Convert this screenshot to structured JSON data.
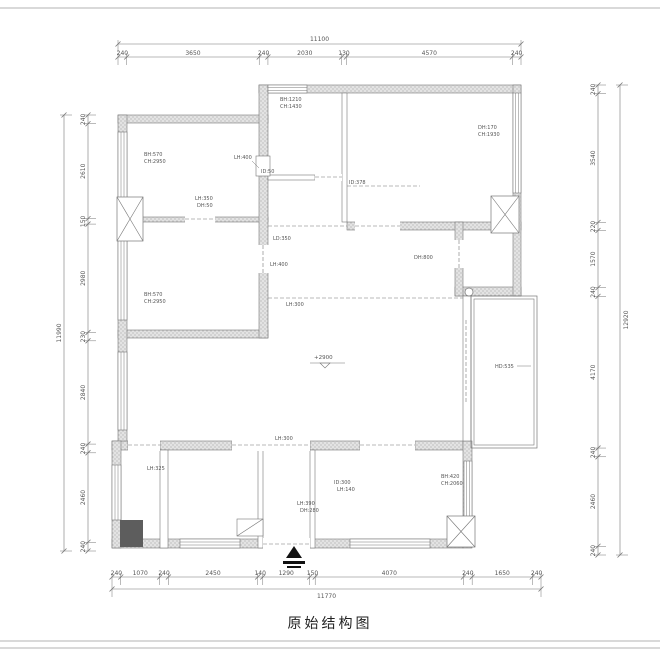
{
  "sheet": {
    "title": "原始结构图"
  },
  "dimensions": {
    "top": {
      "total": "11100",
      "segments": [
        "240",
        "3650",
        "240",
        "2030",
        "130",
        "4570",
        "240"
      ]
    },
    "bottom": {
      "total": "11770",
      "segments": [
        "240",
        "1070",
        "240",
        "2450",
        "140",
        "1290",
        "150",
        "4070",
        "240",
        "1650",
        "240"
      ]
    },
    "left": {
      "total": "11990",
      "segments": [
        "240",
        "2610",
        "150",
        "2980",
        "230",
        "2840",
        "240",
        "2460",
        "240"
      ]
    },
    "right": {
      "total": "12920",
      "segments": [
        "240",
        "3540",
        "220",
        "1570",
        "240",
        "4170",
        "240",
        "2460",
        "240"
      ]
    }
  },
  "level_mark": {
    "text": "+2900",
    "x": 314,
    "y": 359
  },
  "annotations": [
    {
      "text": "BH:570",
      "x": 144,
      "y": 156
    },
    {
      "text": "CH:2950",
      "x": 144,
      "y": 163
    },
    {
      "text": "LH:400",
      "x": 234,
      "y": 159
    },
    {
      "text": "LH:350",
      "x": 195,
      "y": 200
    },
    {
      "text": "DH:50",
      "x": 197,
      "y": 207
    },
    {
      "text": "BH:1210",
      "x": 280,
      "y": 101
    },
    {
      "text": "CH:1430",
      "x": 280,
      "y": 108
    },
    {
      "text": "ID:50",
      "x": 261,
      "y": 173
    },
    {
      "text": "ID:378",
      "x": 349,
      "y": 184
    },
    {
      "text": "DH:170",
      "x": 478,
      "y": 129
    },
    {
      "text": "CH:1930",
      "x": 478,
      "y": 136
    },
    {
      "text": "LD:350",
      "x": 273,
      "y": 240
    },
    {
      "text": "LH:400",
      "x": 270,
      "y": 266
    },
    {
      "text": "DH:800",
      "x": 414,
      "y": 259
    },
    {
      "text": "LH:300",
      "x": 286,
      "y": 306
    },
    {
      "text": "BH:570",
      "x": 144,
      "y": 296
    },
    {
      "text": "CH:2950",
      "x": 144,
      "y": 303
    },
    {
      "text": "HD:535",
      "x": 495,
      "y": 368
    },
    {
      "text": "LH:300",
      "x": 275,
      "y": 440
    },
    {
      "text": "LH:325",
      "x": 147,
      "y": 470
    },
    {
      "text": "ID:300",
      "x": 334,
      "y": 484
    },
    {
      "text": "LH:140",
      "x": 337,
      "y": 491
    },
    {
      "text": "LH:390",
      "x": 297,
      "y": 505
    },
    {
      "text": "DH:280",
      "x": 300,
      "y": 512
    },
    {
      "text": "BH:420",
      "x": 441,
      "y": 478
    },
    {
      "text": "CH:2060",
      "x": 441,
      "y": 485
    }
  ],
  "colors": {
    "line": "#777777",
    "text": "#555555",
    "hatch_dot": "#8f8f8f",
    "hatch_bg": "#e3e3e3",
    "entry_arrow": "#111111"
  }
}
